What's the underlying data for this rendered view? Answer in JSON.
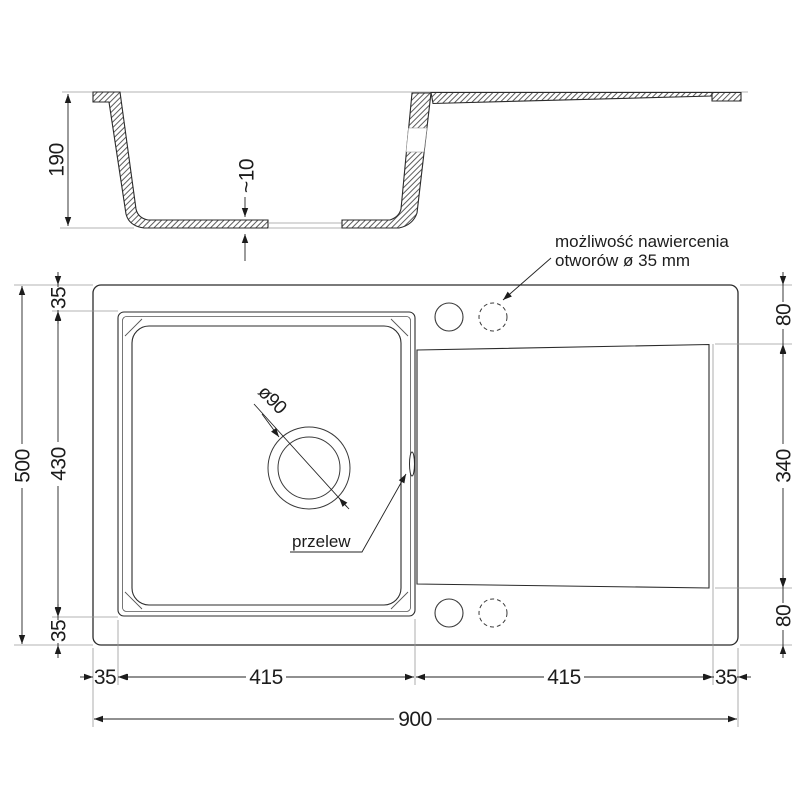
{
  "side_view": {
    "depth": "190",
    "base_thickness": "~10"
  },
  "plan_view": {
    "drain_diameter": "ø90",
    "overflow_label": "przelew",
    "note_line1": "możliwość nawiercenia",
    "note_line2": "otworów ø 35 mm"
  },
  "dims": {
    "left_total": "500",
    "left_margin_top": "35",
    "left_bowl": "430",
    "left_margin_bottom": "35",
    "right_top": "80",
    "right_mid": "340",
    "right_bottom": "80",
    "bottom_margin_left": "35",
    "bottom_bowl": "415",
    "bottom_drainer": "415",
    "bottom_margin_right": "35",
    "bottom_total": "900"
  },
  "colors": {
    "line": "#2b2b2b",
    "thin_line": "#9a9a9a",
    "background": "#ffffff"
  }
}
